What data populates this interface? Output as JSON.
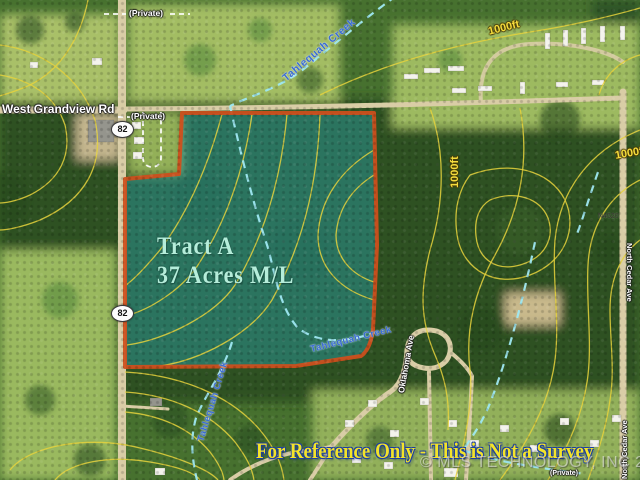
{
  "map": {
    "tract": {
      "name": "Tract A",
      "acreage": "37 Acres M/L"
    },
    "disclaimer": "For Reference Only - This is Not a Survey",
    "watermark": "© MLS TECHNOLOGY, INC 2021",
    "roads": {
      "west_grandview": "West Grandview Rd",
      "private": "(Private)",
      "oklahoma_ave": "Oklahoma Ave",
      "north_cedar_ave": "North Cedar Ave",
      "highway_82": "82",
      "n4520": "N4520"
    },
    "creeks": {
      "name": "Tahlequah Creek"
    },
    "contours": {
      "elevation_label": "1000ft"
    },
    "colors": {
      "boundary": "#d04f1c",
      "tract_fill": "rgba(40,165,180,0.42)",
      "contour": "#e6d23c",
      "creek": "#9fe8f2",
      "road": "#d9cda6",
      "tract_text": "#b5edda",
      "disclaimer_text": "#f3e32a",
      "disclaimer_outline": "#1d3fa0",
      "creek_text": "#3a6cd4",
      "contour_text": "#f5dd3d"
    }
  }
}
